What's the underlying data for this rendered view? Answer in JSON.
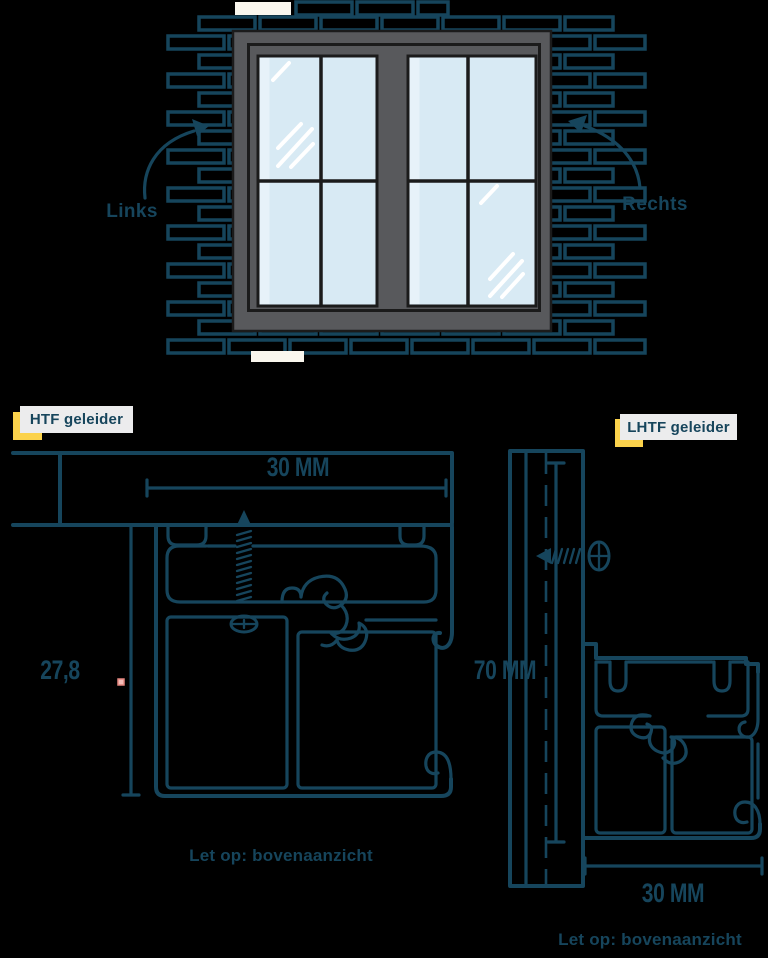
{
  "colors": {
    "line": "#16455C",
    "yellow": "#FBD24B",
    "label_bg": "#ECECED",
    "frame_gray": "#58595C",
    "outline": "#1B1B1B",
    "glass": "#D8EAF4",
    "glass_light": "#E7F2F9",
    "shine": "#FFFFFF",
    "brick_white": "#FAF7EE",
    "pink": "#F5BDB8",
    "pink_border": "#E4867F",
    "bg": "#000000"
  },
  "window_figure": {
    "left_label": "Links",
    "right_label": "Rechts"
  },
  "htf": {
    "tag": "HTF geleider",
    "width_dim": "30 MM",
    "depth_dim": "27,8",
    "note": "Let op: bovenaanzicht"
  },
  "lhtf": {
    "tag": "LHTF geleider",
    "height_dim": "70 MM",
    "width_dim": "30 MM",
    "note": "Let op: bovenaanzicht"
  }
}
